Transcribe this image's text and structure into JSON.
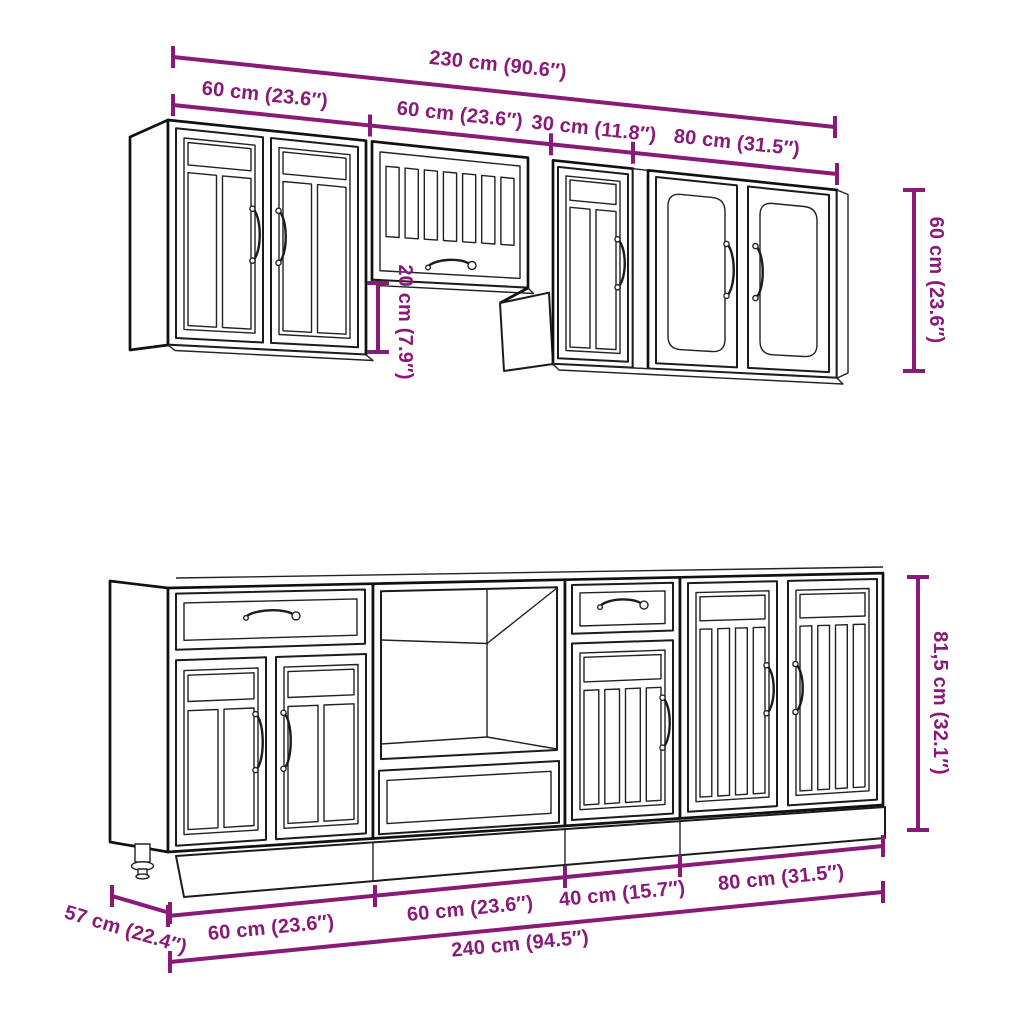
{
  "diagram": {
    "accent_color": "#8a1a78",
    "line_color": "#1c1c1c",
    "dims": {
      "top_total": "230 cm (90.6″)",
      "top_seg1": "60 cm (23.6″)",
      "top_seg2": "60 cm (23.6″)",
      "top_seg3": "30 cm (11.8″)",
      "top_seg4": "80 cm (31.5″)",
      "wall_height": "60 cm (23.6″)",
      "wall_gap": "20 cm (7.9″)",
      "base_depth": "57 cm (22.4″)",
      "base_seg1": "60 cm (23.6″)",
      "base_seg2": "60 cm (23.6″)",
      "base_seg3": "40 cm (15.7″)",
      "base_seg4": "80 cm (31.5″)",
      "base_height": "81,5 cm (32.1″)",
      "base_total": "240 cm (94.5″)"
    }
  }
}
